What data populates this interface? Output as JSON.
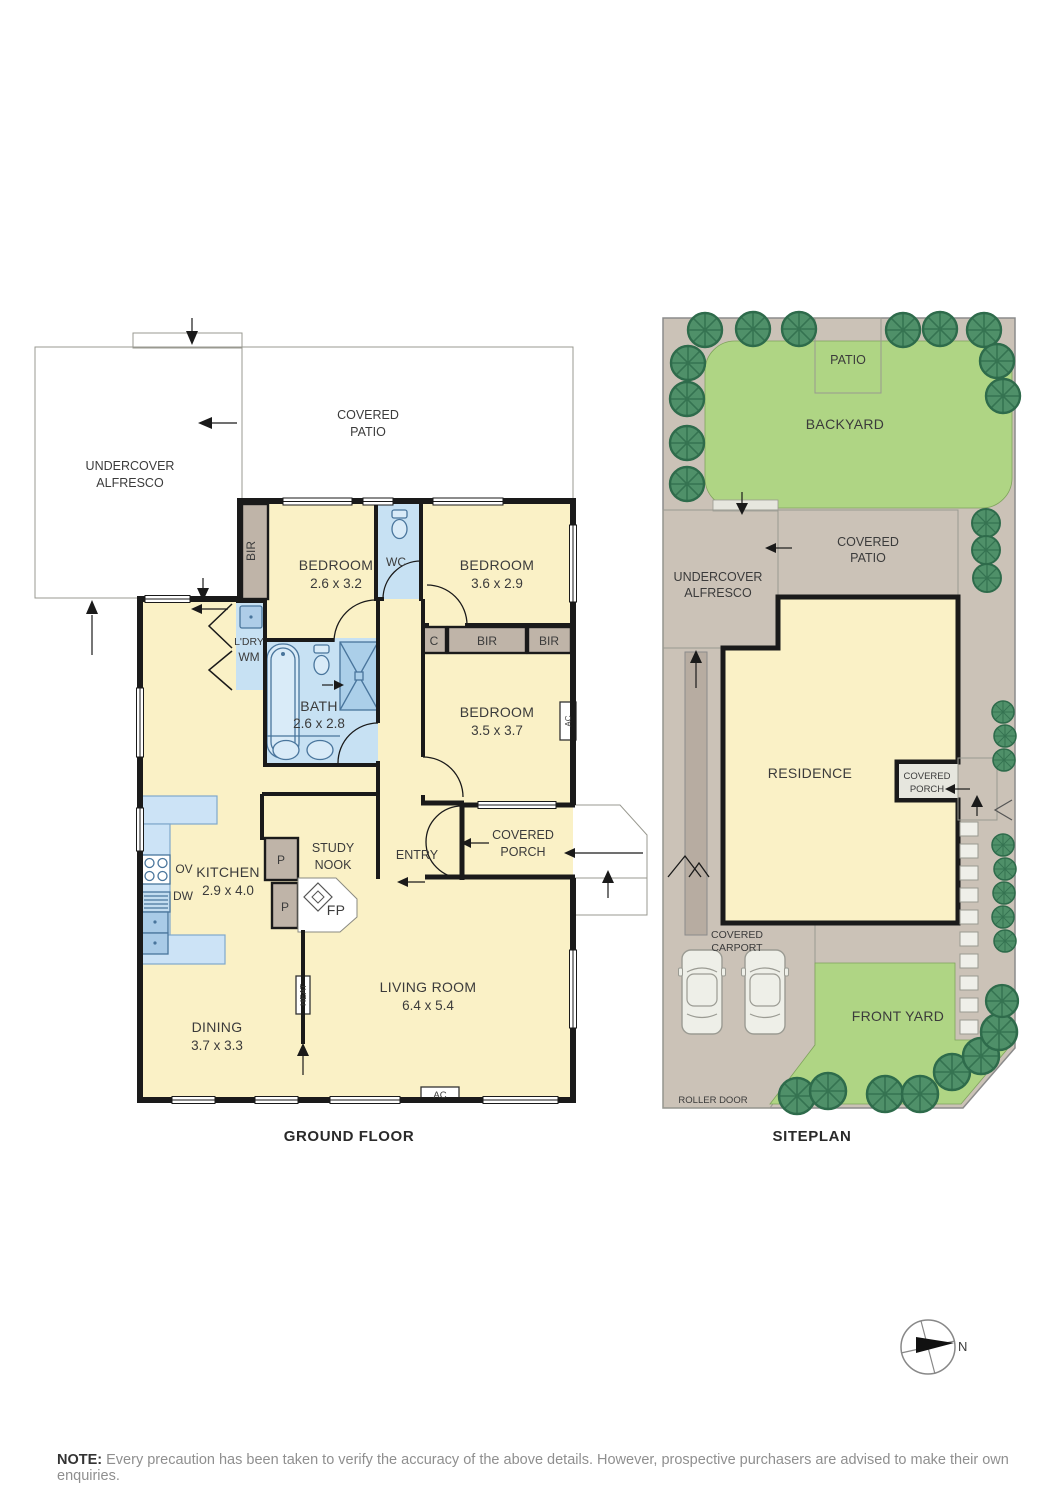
{
  "floorplan": {
    "title": "GROUND FLOOR",
    "covered_patio_l1": "COVERED",
    "covered_patio_l2": "PATIO",
    "alfresco_l1": "UNDERCOVER",
    "alfresco_l2": "ALFRESCO",
    "bedroom1_name": "BEDROOM",
    "bedroom1_dims": "2.6 x 3.2",
    "bedroom2_name": "BEDROOM",
    "bedroom2_dims": "3.6 x 2.9",
    "bedroom3_name": "BEDROOM",
    "bedroom3_dims": "3.5 x 3.7",
    "bath_name": "BATH",
    "bath_dims": "2.6 x 2.8",
    "kitchen_name": "KITCHEN",
    "kitchen_dims": "2.9 x 4.0",
    "dining_name": "DINING",
    "dining_dims": "3.7 x 3.3",
    "living_name": "LIVING ROOM",
    "living_dims": "6.4 x 5.4",
    "wc": "WC",
    "entry": "ENTRY",
    "study_l1": "STUDY",
    "study_l2": "NOOK",
    "ldry": "L'DRY",
    "wm": "WM",
    "bir": "BIR",
    "c": "C",
    "p": "P",
    "fp": "FP",
    "ov": "OV",
    "dw": "DW",
    "heat": "HEAT",
    "ac": "AC",
    "porch_l1": "COVERED",
    "porch_l2": "PORCH"
  },
  "siteplan": {
    "title": "SITEPLAN",
    "patio": "PATIO",
    "backyard": "BACKYARD",
    "alfresco_l1": "UNDERCOVER",
    "alfresco_l2": "ALFRESCO",
    "covered_patio_l1": "COVERED",
    "covered_patio_l2": "PATIO",
    "residence": "RESIDENCE",
    "porch_l1": "COVERED",
    "porch_l2": "PORCH",
    "carport_l1": "COVERED",
    "carport_l2": "CARPORT",
    "front_yard": "FRONT YARD",
    "roller_door": "ROLLER DOOR"
  },
  "compass": {
    "north": "N"
  },
  "note": {
    "prefix": "NOTE:",
    "text": " Every precaution has been taken to verify the accuracy of the above details. However, prospective purchasers are advised to make their own enquiries."
  },
  "colors": {
    "room_fill": "#FAF1C6",
    "wet_area_fill": "#C7E1F3",
    "closet_fill": "#BFB4A8",
    "patio_fill": "#E6E6DE",
    "grass_green": "#AFD584",
    "tree_green": "#4F9069",
    "path_brown": "#CBC2B7",
    "wall_black": "#1A1A1A"
  }
}
